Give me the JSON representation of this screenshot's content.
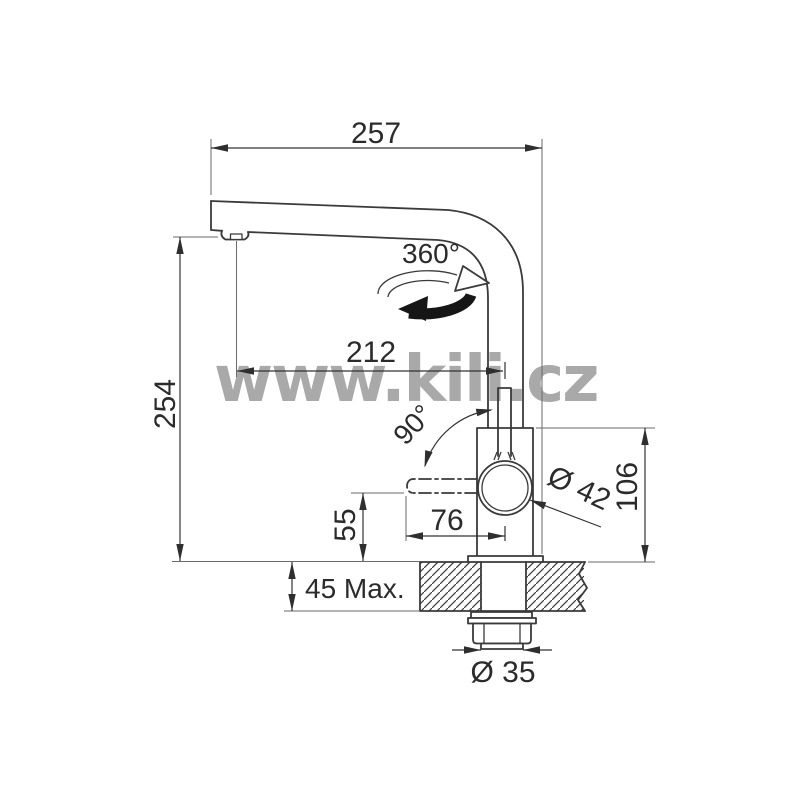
{
  "watermark": {
    "text": "www.kili.cz",
    "color": "#a9a9a9"
  },
  "drawing": {
    "subject": "kitchen-faucet-installation-diagram",
    "line_color": "#3a3a3a",
    "background": "#ffffff"
  },
  "labels": {
    "total_projection": "257",
    "overall_height": "254",
    "spout_projection": "212",
    "swivel_angle": "360°",
    "lever_angle": "90°",
    "lever_length": "76",
    "lever_clearance": "55",
    "body_diameter": "Ø 42",
    "body_height": "106",
    "counter_thickness": "45 Max.",
    "mounting_hole": "Ø 35"
  }
}
